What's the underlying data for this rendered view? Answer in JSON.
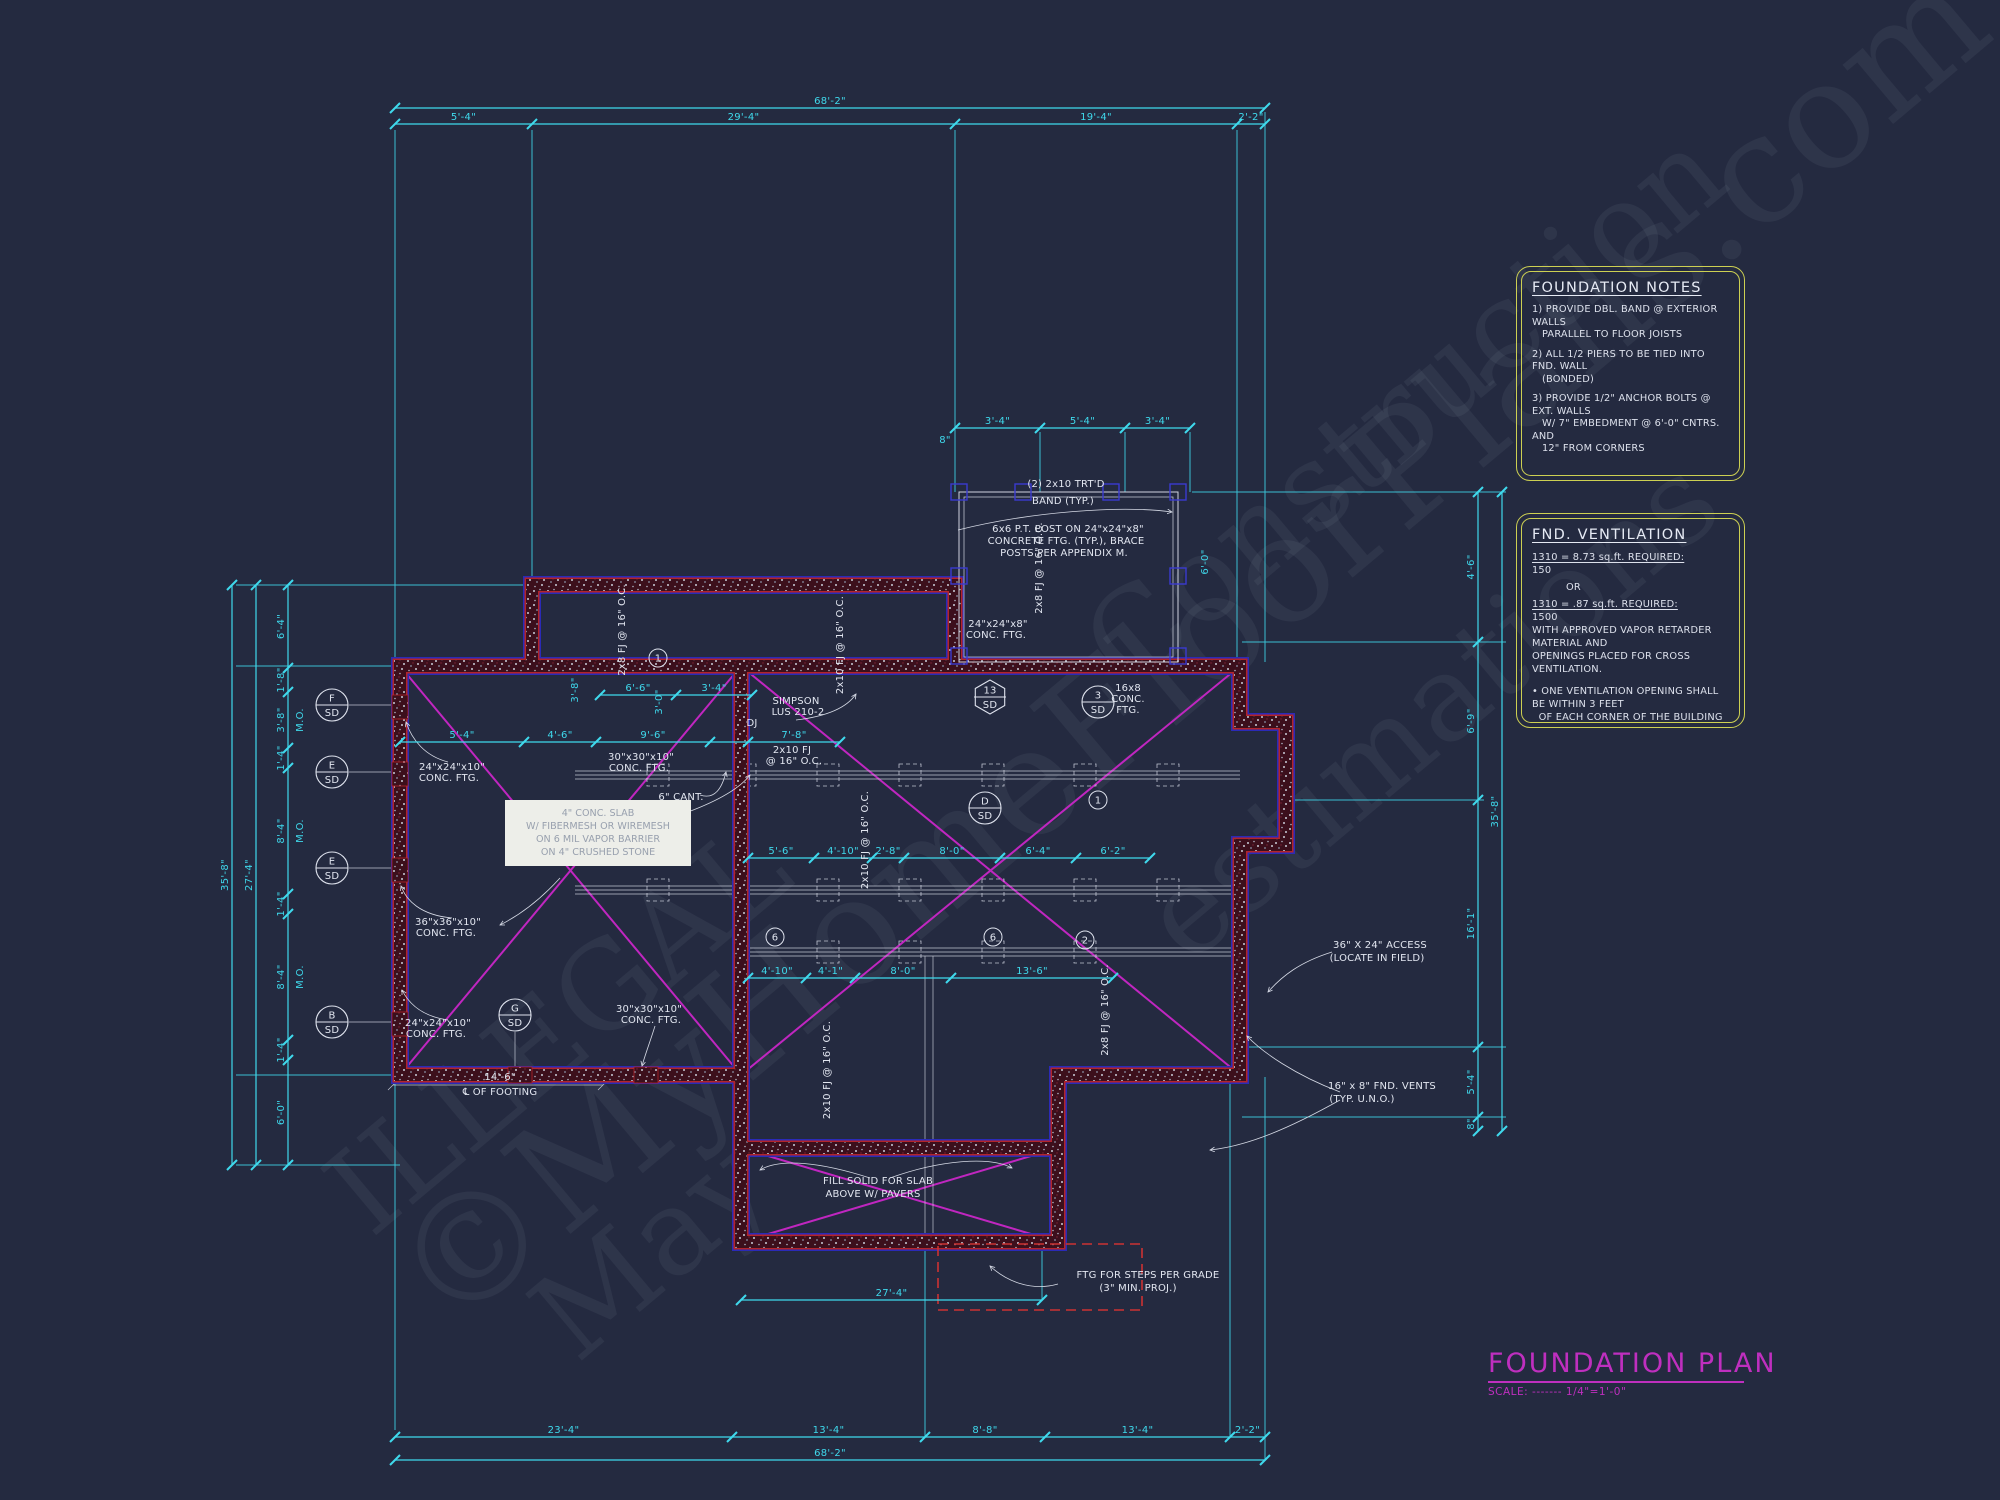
{
  "colors": {
    "background": "#242a40",
    "dimension_cyan": "#3fd9ec",
    "annotation_white": "#e2e6f0",
    "note_border_yellow": "#cdd052",
    "title_magenta": "#bf2fbf",
    "brace_magenta": "#c026c0",
    "wall_red": "#b3242a",
    "wall_blue": "#2a2ab8",
    "stoop_dashed_red": "#cc3333"
  },
  "watermarks": [
    {
      "text": "©MyHomeFloorPlans.com",
      "x": 180,
      "y": 560,
      "size": 150,
      "rot": -40
    },
    {
      "text": "Construction",
      "x": 1010,
      "y": 340,
      "size": 120,
      "rot": -40
    },
    {
      "text": "estimations",
      "x": 1080,
      "y": 640,
      "size": 120,
      "rot": -40
    },
    {
      "text": "ILLEGAL",
      "x": 280,
      "y": 960,
      "size": 120,
      "rot": -40
    },
    {
      "text": "May",
      "x": 520,
      "y": 1180,
      "size": 120,
      "rot": -40
    }
  ],
  "title_block": {
    "title": "FOUNDATION PLAN",
    "scale_label": "SCALE: ------- 1/4\"=1'-0\""
  },
  "foundation_notes": {
    "title": "FOUNDATION NOTES",
    "items": [
      "1) PROVIDE DBL. BAND @ EXTERIOR WALLS\n   PARALLEL TO FLOOR JOISTS",
      "2) ALL 1/2 PIERS TO BE TIED INTO FND. WALL\n   (BONDED)",
      "3) PROVIDE 1/2\" ANCHOR BOLTS @ EXT. WALLS\n   W/ 7\" EMBEDMENT @ 6'-0\" CNTRS. AND\n   12\" FROM CORNERS"
    ]
  },
  "fnd_ventilation": {
    "title": "FND. VENTILATION",
    "req1_line1": "1310 = 8.73 sq.ft. REQUIRED:",
    "req1_line2": "150",
    "or_label": "OR",
    "req2_line1": "1310 = .87 sq.ft. REQUIRED:",
    "req2_line2": "1500",
    "body": "WITH APPROVED VAPOR RETARDER MATERIAL AND\nOPENINGS PLACED FOR CROSS VENTILATION.",
    "bullet": "• ONE VENTILATION OPENING SHALL BE WITHIN 3 FEET\n  OF EACH CORNER OF THE BUILDING"
  },
  "slab_note": {
    "lines": [
      "4\" CONC. SLAB",
      "W/ FIBERMESH OR WIREMESH",
      "ON 6 MIL VAPOR BARRIER",
      "ON 4\" CRUSHED STONE"
    ]
  },
  "plan": {
    "dim_chains": [
      {
        "dir": "h",
        "y": 108,
        "nodes": [
          395,
          1265
        ],
        "labels": [
          "68'-2\""
        ]
      },
      {
        "dir": "h",
        "y": 124,
        "nodes": [
          395,
          532,
          955,
          1237,
          1265
        ],
        "labels": [
          "5'-4\"",
          "29'-4\"",
          "19'-4\"",
          "2'-2\""
        ]
      },
      {
        "dir": "h",
        "y": 1437,
        "nodes": [
          395,
          732,
          925,
          1045,
          1230,
          1265
        ],
        "labels": [
          "23'-4\"",
          "13'-4\"",
          "8'-8\"",
          "13'-4\"",
          "2'-2\""
        ]
      },
      {
        "dir": "h",
        "y": 1460,
        "nodes": [
          395,
          1265
        ],
        "labels": [
          "68'-2\""
        ]
      },
      {
        "dir": "v",
        "x": 232,
        "nodes": [
          585,
          1165
        ],
        "labels": [
          "35'-8\""
        ]
      },
      {
        "dir": "v",
        "x": 256,
        "nodes": [
          585,
          1165
        ],
        "labels": [
          "27'-4\""
        ]
      },
      {
        "dir": "v",
        "x": 288,
        "nodes": [
          585,
          668,
          692,
          748,
          768,
          894,
          914,
          1040,
          1060,
          1165
        ],
        "labels": [
          "6'-4\"",
          "1'-8\"",
          "3'-8\"",
          "1'-4\"",
          "8'-4\"",
          "1'-4\"",
          "8'-4\"",
          "1'-4\"",
          "6'-0\""
        ]
      },
      {
        "dir": "v",
        "x": 1478,
        "nodes": [
          492,
          642,
          800,
          1047,
          1117,
          1131
        ],
        "labels": [
          "4'-6\"",
          "6'-9\"",
          "16'-1\"",
          "5'-4\"",
          "8\""
        ]
      },
      {
        "dir": "v",
        "x": 1502,
        "nodes": [
          492,
          1131
        ],
        "labels": [
          "35'-8\""
        ]
      },
      {
        "dir": "h",
        "y": 428,
        "nodes": [
          955,
          1040,
          1125,
          1190
        ],
        "labels": [
          "3'-4\"",
          "5'-4\"",
          "3'-4\""
        ]
      },
      {
        "dir": "h",
        "y": 1300,
        "nodes": [
          741,
          1042
        ],
        "labels": [
          "27'-4\""
        ]
      },
      {
        "dir": "h",
        "y": 742,
        "nodes": [
          400,
          524,
          596,
          710,
          748,
          840
        ],
        "labels": [
          "5'-4\"",
          "4'-6\"",
          "9'-6\"",
          "",
          "7'-8\""
        ]
      },
      {
        "dir": "h",
        "y": 858,
        "nodes": [
          748,
          814,
          872,
          904,
          1000,
          1076,
          1150
        ],
        "labels": [
          "5'-6\"",
          "4'-10\"",
          "2'-8\"",
          "8'-0\"",
          "6'-4\"",
          "6'-2\""
        ]
      },
      {
        "dir": "h",
        "y": 978,
        "nodes": [
          748,
          806,
          855,
          951,
          1113
        ],
        "labels": [
          "4'-10\"",
          "4'-1\"",
          "8'-0\"",
          "13'-6\""
        ]
      },
      {
        "dir": "h",
        "y": 695,
        "nodes": [
          600,
          676,
          752
        ],
        "labels": [
          "6'-6\"",
          "3'-4\""
        ]
      }
    ],
    "dim_labels": [
      {
        "t": "3'-8\"",
        "x": 578,
        "y": 690,
        "r": -90
      },
      {
        "t": "3'-0\"",
        "x": 662,
        "y": 702,
        "r": -90
      },
      {
        "t": "6'-0\"",
        "x": 1208,
        "y": 562,
        "r": -90
      },
      {
        "t": "8\"",
        "x": 945,
        "y": 443
      },
      {
        "t": "M.O.",
        "x": 303,
        "y": 720,
        "r": -90
      },
      {
        "t": "M.O.",
        "x": 303,
        "y": 831,
        "r": -90
      },
      {
        "t": "M.O.",
        "x": 303,
        "y": 977,
        "r": -90
      }
    ],
    "annotations": [
      {
        "t": "(2) 2x10 TRT'D",
        "x": 1066,
        "y": 487
      },
      {
        "t": "BAND (TYP.)",
        "x": 1063,
        "y": 504
      },
      {
        "t": "6x6 P.T. POST ON 24\"x24\"x8\"",
        "x": 1068,
        "y": 532
      },
      {
        "t": "CONCRETE FTG. (TYP.), BRACE",
        "x": 1066,
        "y": 544
      },
      {
        "t": "POSTS PER APPENDIX M.",
        "x": 1064,
        "y": 556
      },
      {
        "t": "SIMPSON",
        "x": 796,
        "y": 704
      },
      {
        "t": "LUS 210-2",
        "x": 798,
        "y": 715
      },
      {
        "t": "2x10 FJ",
        "x": 792,
        "y": 753
      },
      {
        "t": "@ 16\" O.C.",
        "x": 794,
        "y": 764
      },
      {
        "t": "30\"x30\"x10\"",
        "x": 641,
        "y": 760
      },
      {
        "t": "CONC. FTG.",
        "x": 639,
        "y": 771
      },
      {
        "t": "6\" CANT.",
        "x": 681,
        "y": 800
      },
      {
        "t": "24\"x24\"x10\"",
        "x": 452,
        "y": 770
      },
      {
        "t": "CONC. FTG.",
        "x": 449,
        "y": 781
      },
      {
        "t": "36\"x36\"x10\"",
        "x": 448,
        "y": 925
      },
      {
        "t": "CONC. FTG.",
        "x": 446,
        "y": 936
      },
      {
        "t": "24\"x24\"x10\"",
        "x": 438,
        "y": 1026
      },
      {
        "t": "CONC. FTG.",
        "x": 436,
        "y": 1037
      },
      {
        "t": "30\"x30\"x10\"",
        "x": 649,
        "y": 1012
      },
      {
        "t": "CONC. FTG.",
        "x": 651,
        "y": 1023
      },
      {
        "t": "14'-6\"",
        "x": 500,
        "y": 1080
      },
      {
        "t": "℄ OF FOOTING",
        "x": 500,
        "y": 1095
      },
      {
        "t": "16x8",
        "x": 1128,
        "y": 691
      },
      {
        "t": "CONC.",
        "x": 1128,
        "y": 702
      },
      {
        "t": "FTG.",
        "x": 1128,
        "y": 713
      },
      {
        "t": "24\"x24\"x8\"",
        "x": 998,
        "y": 627
      },
      {
        "t": "CONC. FTG.",
        "x": 996,
        "y": 638
      },
      {
        "t": "36\" X 24\" ACCESS",
        "x": 1380,
        "y": 948
      },
      {
        "t": "(LOCATE IN FIELD)",
        "x": 1377,
        "y": 961
      },
      {
        "t": "16\" x 8\" FND. VENTS",
        "x": 1382,
        "y": 1089
      },
      {
        "t": "(TYP. U.N.O.)",
        "x": 1362,
        "y": 1102
      },
      {
        "t": "FILL SOLID FOR SLAB",
        "x": 878,
        "y": 1184
      },
      {
        "t": "ABOVE W/ PAVERS",
        "x": 873,
        "y": 1197
      },
      {
        "t": "FTG FOR STEPS PER GRADE",
        "x": 1148,
        "y": 1278
      },
      {
        "t": "(3\" MIN. PROJ.)",
        "x": 1138,
        "y": 1291
      },
      {
        "t": "2x8 FJ @ 16\" O.C.",
        "x": 625,
        "y": 630,
        "r": -90
      },
      {
        "t": "2x10 FJ @ 16\" O.C.",
        "x": 843,
        "y": 645,
        "r": -90
      },
      {
        "t": "2x8 FJ @ 16\" O.C.",
        "x": 1042,
        "y": 568,
        "r": -90
      },
      {
        "t": "2x10 FJ @ 16\" O.C.",
        "x": 868,
        "y": 840,
        "r": -90
      },
      {
        "t": "2x10 FJ @ 16\" O.C.",
        "x": 830,
        "y": 1070,
        "r": -90
      },
      {
        "t": "2x8 FJ @ 16\" O.C.",
        "x": 1108,
        "y": 1010,
        "r": -90
      },
      {
        "t": "DJ",
        "x": 752,
        "y": 726
      }
    ],
    "pier_marks": [
      {
        "top": "F",
        "bottom": "SD",
        "x": 332,
        "y": 705,
        "shape": "circle"
      },
      {
        "top": "E",
        "bottom": "SD",
        "x": 332,
        "y": 772,
        "shape": "circle"
      },
      {
        "top": "E",
        "bottom": "SD",
        "x": 332,
        "y": 868,
        "shape": "circle"
      },
      {
        "top": "B",
        "bottom": "SD",
        "x": 332,
        "y": 1022,
        "shape": "circle"
      },
      {
        "top": "G",
        "bottom": "SD",
        "x": 515,
        "y": 1015,
        "shape": "circle"
      },
      {
        "top": "D",
        "bottom": "SD",
        "x": 985,
        "y": 808,
        "shape": "circle"
      },
      {
        "top": "3",
        "bottom": "SD",
        "x": 1098,
        "y": 702,
        "shape": "circle"
      },
      {
        "top": "13",
        "bottom": "SD",
        "x": 990,
        "y": 697,
        "shape": "hex"
      }
    ],
    "bubbles": [
      {
        "t": "1",
        "x": 658,
        "y": 658
      },
      {
        "t": "1",
        "x": 1098,
        "y": 800
      },
      {
        "t": "6",
        "x": 775,
        "y": 937
      },
      {
        "t": "6",
        "x": 993,
        "y": 937
      },
      {
        "t": "2",
        "x": 1085,
        "y": 940
      }
    ]
  }
}
